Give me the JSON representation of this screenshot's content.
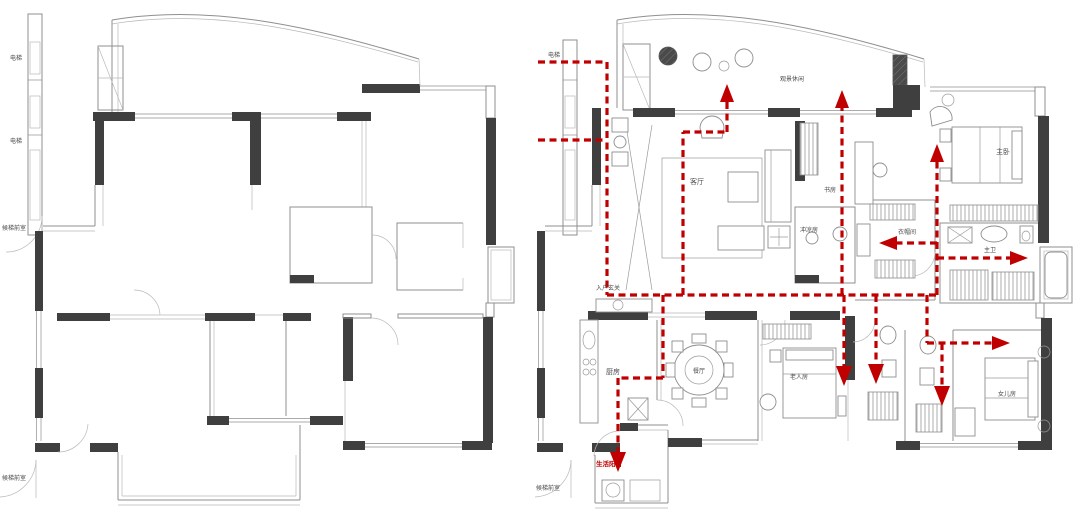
{
  "figure": {
    "description_left_panel": "empty floor plan shell",
    "description_right_panel": "furnished floor plan with red circulation arrows"
  },
  "colors": {
    "wall": "#3f3f3f",
    "line": "#8f8f8f",
    "line_light": "#b9b9b9",
    "red": "#c00000",
    "label": "#4a4a4a"
  },
  "labels": {
    "elevator": "电梯",
    "elevator_lobby": "候梯前室",
    "balcony_leisure": "观景休闲",
    "living_room": "客厅",
    "study": "书房",
    "shower_room": "冲凉房",
    "master_bedroom": "主卧",
    "cloakroom": "衣帽间",
    "master_bath": "主卫",
    "entry_foyer": "入户玄关",
    "kitchen": "厨房",
    "dining_room": "餐厅",
    "elder_room": "老人房",
    "daughter_room": "女儿房",
    "service_balcony": "生活阳台"
  }
}
